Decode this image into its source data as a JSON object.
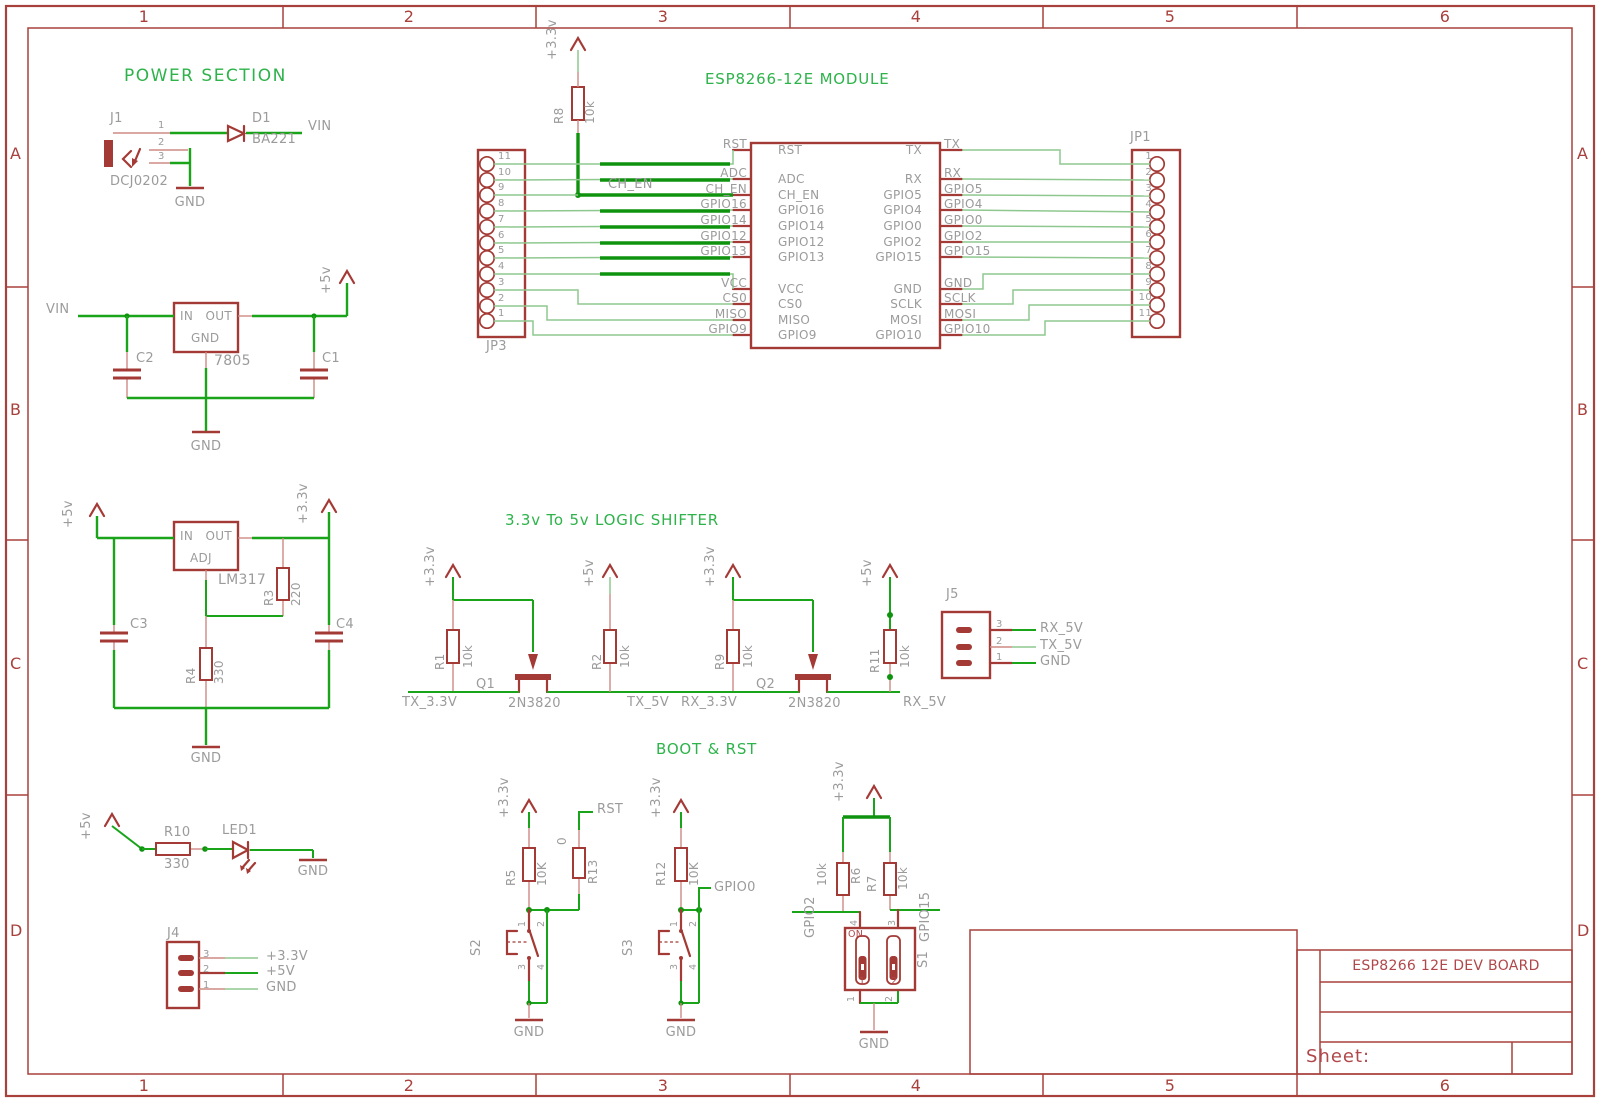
{
  "colors": {
    "wire_green": "#1aa41a",
    "wire_thin": "#8fc88f",
    "wire_thick": "#0f930f",
    "symbol_red": "#a43a35",
    "label_gray": "#9b9b9b",
    "frame_red": "#a8403c",
    "title_green": "#2db34a"
  },
  "frame": {
    "columns": [
      "1",
      "2",
      "3",
      "4",
      "5",
      "6"
    ],
    "rows": [
      "A",
      "B",
      "C",
      "D"
    ]
  },
  "titles": {
    "power": "POWER SECTION",
    "module": "ESP8266-12E MODULE",
    "shifter": "3.3v To 5v LOGIC SHIFTER",
    "boot": "BOOT & RST"
  },
  "title_block": {
    "board": "ESP8266 12E DEV BOARD",
    "sheet": "Sheet:"
  },
  "j1": {
    "ref": "J1",
    "part": "DCJ0202",
    "pin1": "1",
    "pin2": "2",
    "pin3": "3",
    "gnd": "GND"
  },
  "d1": {
    "ref": "D1",
    "part": "BA221",
    "net": "VIN"
  },
  "reg5": {
    "vin": "VIN",
    "in": "IN",
    "out": "OUT",
    "gnd_pin": "GND",
    "part": "7805",
    "c_in": "C2",
    "c_out": "C1",
    "rail": "+5v",
    "gnd": "GND"
  },
  "reg33": {
    "rail_in": "+5v",
    "rail_out": "+3.3v",
    "in": "IN",
    "out": "OUT",
    "adj": "ADJ",
    "part": "LM317",
    "r3": "R3",
    "r3_val": "220",
    "r4": "R4",
    "r4_val": "330",
    "c_in": "C3",
    "c_out": "C4",
    "gnd": "GND"
  },
  "r8": {
    "ref": "R8",
    "value": "10k",
    "rail": "+3.3v",
    "net": "CH_EN"
  },
  "module": {
    "jp3_ref": "JP3",
    "jp1_ref": "JP1",
    "jp3_pins": [
      "11",
      "10",
      "9",
      "8",
      "7",
      "6",
      "5",
      "4",
      "3",
      "2",
      "1"
    ],
    "jp1_pins": [
      "1",
      "2",
      "3",
      "4",
      "5",
      "6",
      "7",
      "8",
      "9",
      "10",
      "11"
    ],
    "left": [
      "RST",
      "ADC",
      "CH_EN",
      "GPIO16",
      "GPIO14",
      "GPIO12",
      "GPIO13",
      "VCC",
      "CS0",
      "MISO",
      "GPIO9"
    ],
    "right": [
      "TX",
      "RX",
      "GPIO5",
      "GPIO4",
      "GPIO0",
      "GPIO2",
      "GPIO15",
      "GND",
      "SCLK",
      "MOSI",
      "GPIO10"
    ]
  },
  "shifter": {
    "tx": {
      "rail_l": "+3.3v",
      "r_l": "R1",
      "r_l_val": "10k",
      "q": "Q1",
      "q_part": "2N3820",
      "net_l": "TX_3.3V",
      "rail_r": "+5v",
      "r_r": "R2",
      "r_r_val": "10k",
      "net_r": "TX_5V"
    },
    "rx": {
      "rail_l": "+3.3v",
      "r_l": "R9",
      "r_l_val": "10k",
      "q": "Q2",
      "q_part": "2N3820",
      "net_l": "RX_3.3V",
      "rail_r": "+5v",
      "r_r": "R11",
      "r_r_val": "10k",
      "net_r": "RX_5V"
    },
    "j5": {
      "ref": "J5",
      "pins": [
        "3",
        "2",
        "1"
      ],
      "nets": [
        "RX_5V",
        "TX_5V",
        "GND"
      ]
    }
  },
  "boot": {
    "s2": {
      "rail": "+3.3v",
      "r": "R5",
      "r_val": "10K",
      "r2": "R13",
      "r2_val": "0",
      "net": "RST",
      "ref": "S2",
      "p1": "1",
      "p2": "2",
      "p3": "3",
      "p4": "4",
      "gnd": "GND"
    },
    "s3": {
      "rail": "+3.3v",
      "r": "R12",
      "r_val": "10K",
      "net": "GPIO0",
      "ref": "S3",
      "p1": "1",
      "p2": "2",
      "p3": "3",
      "p4": "4",
      "gnd": "GND"
    },
    "s1": {
      "rail": "+3.3v",
      "r_l": "R6",
      "r_l_val": "10k",
      "r_r": "R7",
      "r_r_val": "10k",
      "net_l": "GPIO2",
      "net_r": "GPIO15",
      "on": "ON",
      "ref": "S1",
      "pt1": "4",
      "pt2": "3",
      "pb1": "1",
      "pb2": "2",
      "pi1": "1",
      "pi2": "2",
      "gnd": "GND"
    }
  },
  "led": {
    "rail": "+5v",
    "r": "R10",
    "r_val": "330",
    "ref": "LED1",
    "gnd": "GND"
  },
  "j4": {
    "ref": "J4",
    "pins": [
      "3",
      "2",
      "1"
    ],
    "nets": [
      "+3.3V",
      "+5V",
      "GND"
    ]
  }
}
